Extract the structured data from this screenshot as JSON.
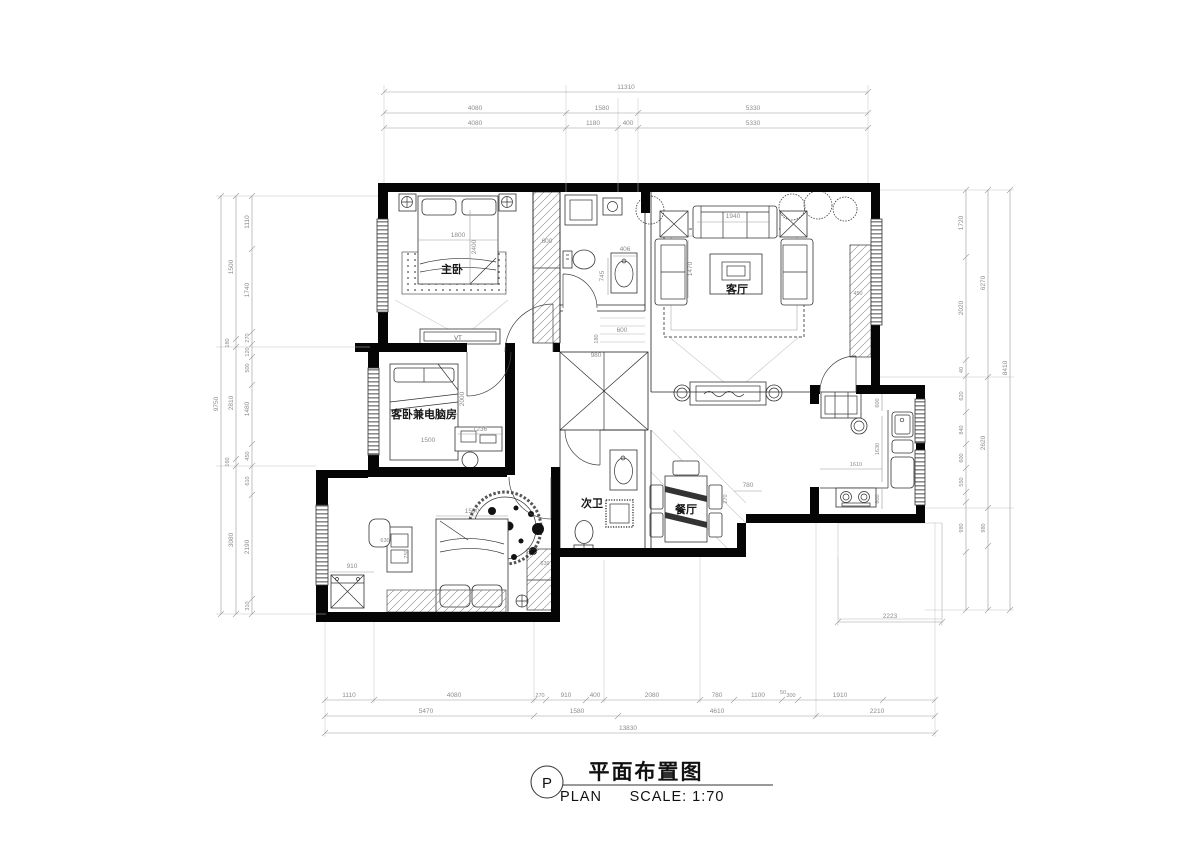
{
  "title": {
    "tag": "P",
    "cn": "平面布置图",
    "plan": "PLAN",
    "scale": "SCALE: 1:70"
  },
  "rooms": {
    "master": "主卧",
    "living": "客厅",
    "guest": "客卧兼电脑房",
    "bath2": "次卫",
    "dining": "餐厅",
    "tv": "VT"
  },
  "dims": {
    "top": {
      "overall": "11310",
      "t2": [
        "4080",
        "1580",
        "5330"
      ],
      "t3": [
        "4080",
        "1180",
        "400",
        "5330"
      ]
    },
    "bottom": {
      "t1": [
        "1110",
        "4080",
        "270",
        "910",
        "400",
        "2080",
        "780",
        "1100",
        "50",
        "300",
        "1910"
      ],
      "t2": [
        "5470",
        "1580",
        "4610",
        "2210"
      ],
      "overall": "13830"
    },
    "left": {
      "overall": "9750",
      "mid": [
        "1500",
        "180",
        "2810",
        "160",
        "3080"
      ],
      "inner": [
        "1110",
        "1740",
        "270",
        "120",
        "500",
        "1480",
        "450",
        "610",
        "2190",
        "310"
      ]
    },
    "right": {
      "overall": "8410",
      "mid": [
        "6270",
        "2620",
        "980"
      ],
      "inner": [
        "1720",
        "2020",
        "40",
        "620",
        "840",
        "600",
        "550",
        "980"
      ]
    },
    "interior": {
      "master_bed": "1800",
      "master_depth": "2400",
      "master_closet": "600",
      "bath1_sink_w": "406",
      "bath1_sink_h": "745",
      "hall_a": "600",
      "hall_b": "180",
      "hall_c": "980",
      "sofa_w": "1940",
      "sofa_d": "1470",
      "living_col": "450",
      "guest_bed_l": "2000",
      "guest_bed_w": "1500",
      "guest_desk": "1236",
      "dining_w": "780",
      "dining_d": "270",
      "kitchen_a": "600",
      "kitchen_b": "1630",
      "kitchen_c": "1610",
      "kitchen_d": "600",
      "bed2_w": "1500",
      "desk2_w": "630",
      "desk2_d": "750",
      "wash_w": "910",
      "wardrobe2": "630",
      "balcony": "2223"
    }
  }
}
